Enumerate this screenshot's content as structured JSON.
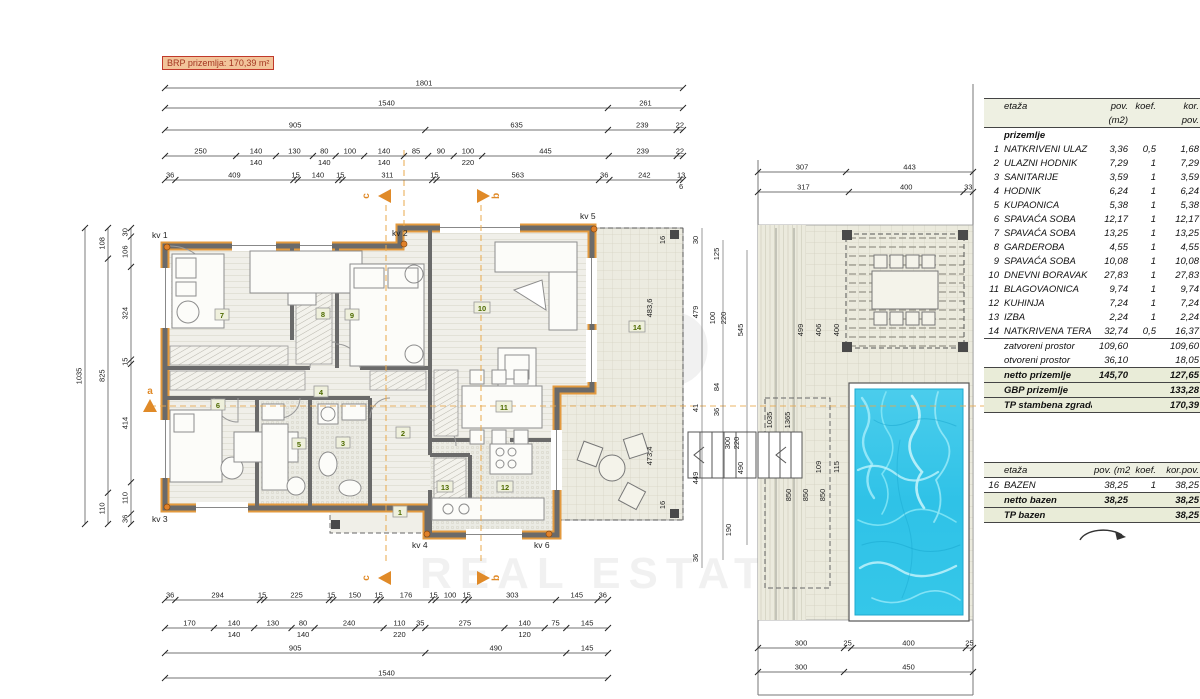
{
  "plan": {
    "brp_label": "BRP prizemlja: 170,39 m²",
    "room_tags": [
      "1",
      "2",
      "3",
      "4",
      "5",
      "6",
      "7",
      "8",
      "9",
      "10",
      "11",
      "12",
      "13",
      "14"
    ],
    "kv_markers": [
      "kv 1",
      "kv 2",
      "kv 3",
      "kv 4",
      "kv 5",
      "kv 6"
    ],
    "section_markers": [
      "a",
      "b",
      "c"
    ],
    "watermark": {
      "l1": "IST",
      "l2": "P",
      "bottom": "REAL ESTATE"
    }
  },
  "colors": {
    "accent": "#e39a3e",
    "pool_water": "#35c5e8",
    "table_shade": "#e9ecd8",
    "wall": "#6a6a6a"
  },
  "dims": {
    "top": [
      [
        "1801"
      ],
      [
        "1540",
        "261"
      ],
      [
        "905",
        "635",
        "239",
        "22"
      ],
      [
        "250",
        "140|140",
        "130",
        "80|140",
        "100",
        "140|140",
        "85",
        "90",
        "100|220",
        "445",
        "239",
        "22"
      ],
      [
        "36",
        "409",
        "15",
        "140",
        "15",
        "311",
        "15",
        "563",
        "36",
        "242",
        "13|6"
      ]
    ],
    "bottom": [
      [
        "36",
        "294",
        "15",
        "225",
        "15",
        "150",
        "15",
        "176",
        "15",
        "100",
        "15",
        "303",
        "145",
        "36"
      ],
      [
        "170",
        "140|140",
        "130",
        "80|140",
        "240",
        "110|220",
        "35",
        "275",
        "140|120",
        "75",
        "145"
      ],
      [
        "905",
        "490",
        "145"
      ],
      [
        "1540"
      ]
    ],
    "left": [
      [
        "1035"
      ],
      [
        "108",
        "825",
        "110"
      ],
      [
        "30",
        "106",
        "324",
        "15",
        "414",
        "110",
        "36"
      ]
    ],
    "patio_top": [
      [
        "307",
        "443"
      ],
      [
        "317",
        "400",
        "33"
      ]
    ],
    "patio_bottom": [
      [
        "300",
        "25",
        "400",
        "25"
      ],
      [
        "300",
        "450"
      ]
    ],
    "floats": [
      "483,6",
      "473,4",
      "16",
      "16",
      "30",
      "479",
      "41",
      "449",
      "36",
      "125",
      "100",
      "220",
      "84",
      "36",
      "300",
      "220",
      "190",
      "545",
      "490",
      "1035",
      "1365",
      "499",
      "406",
      "400",
      "109",
      "115",
      "850",
      "850",
      "850"
    ]
  },
  "tables": {
    "main": {
      "header": [
        "etaža",
        "pov.",
        "koef.",
        "kor."
      ],
      "header2": [
        "",
        "(m2)",
        "",
        "pov."
      ],
      "section_title": "prizemlje",
      "rows": [
        {
          "no": "1",
          "name": "NATKRIVENI ULAZ",
          "pov": "3,36",
          "koef": "0,5",
          "kor": "1,68"
        },
        {
          "no": "2",
          "name": "ULAZNI HODNIK",
          "pov": "7,29",
          "koef": "1",
          "kor": "7,29"
        },
        {
          "no": "3",
          "name": "SANITARIJE",
          "pov": "3,59",
          "koef": "1",
          "kor": "3,59"
        },
        {
          "no": "4",
          "name": "HODNIK",
          "pov": "6,24",
          "koef": "1",
          "kor": "6,24"
        },
        {
          "no": "5",
          "name": "KUPAONICA",
          "pov": "5,38",
          "koef": "1",
          "kor": "5,38"
        },
        {
          "no": "6",
          "name": "SPAVAĆA SOBA",
          "pov": "12,17",
          "koef": "1",
          "kor": "12,17"
        },
        {
          "no": "7",
          "name": "SPAVAĆA SOBA",
          "pov": "13,25",
          "koef": "1",
          "kor": "13,25"
        },
        {
          "no": "8",
          "name": "GARDEROBA",
          "pov": "4,55",
          "koef": "1",
          "kor": "4,55"
        },
        {
          "no": "9",
          "name": "SPAVAĆA SOBA",
          "pov": "10,08",
          "koef": "1",
          "kor": "10,08"
        },
        {
          "no": "10",
          "name": "DNEVNI BORAVAK",
          "pov": "27,83",
          "koef": "1",
          "kor": "27,83"
        },
        {
          "no": "11",
          "name": "BLAGOVAONICA",
          "pov": "9,74",
          "koef": "1",
          "kor": "9,74"
        },
        {
          "no": "12",
          "name": "KUHINJA",
          "pov": "7,24",
          "koef": "1",
          "kor": "7,24"
        },
        {
          "no": "13",
          "name": "IZBA",
          "pov": "2,24",
          "koef": "1",
          "kor": "2,24"
        },
        {
          "no": "14",
          "name": "NATKRIVENA TERASA",
          "pov": "32,74",
          "koef": "0,5",
          "kor": "16,37"
        }
      ],
      "subtotals": [
        {
          "label": "zatvoreni prostor",
          "pov": "109,60",
          "kor": "109,60"
        },
        {
          "label": "otvoreni prostor",
          "pov": "36,10",
          "kor": "18,05"
        }
      ],
      "totals": [
        {
          "label": "netto prizemlje",
          "pov": "145,70",
          "kor": "127,65"
        },
        {
          "label": "GBP prizemlje",
          "pov": "",
          "kor": "133,28"
        },
        {
          "label": "TP stambena zgrada",
          "pov": "",
          "kor": "170,39"
        }
      ]
    },
    "pool": {
      "header": [
        "etaža",
        "pov. (m2)",
        "koef.",
        "kor.pov."
      ],
      "rows": [
        {
          "no": "16",
          "name": "BAZEN",
          "pov": "38,25",
          "koef": "1",
          "kor": "38,25"
        }
      ],
      "totals": [
        {
          "label": "netto bazen",
          "pov": "38,25",
          "kor": "38,25"
        },
        {
          "label": "TP bazen",
          "pov": "",
          "kor": "38,25"
        }
      ]
    }
  }
}
